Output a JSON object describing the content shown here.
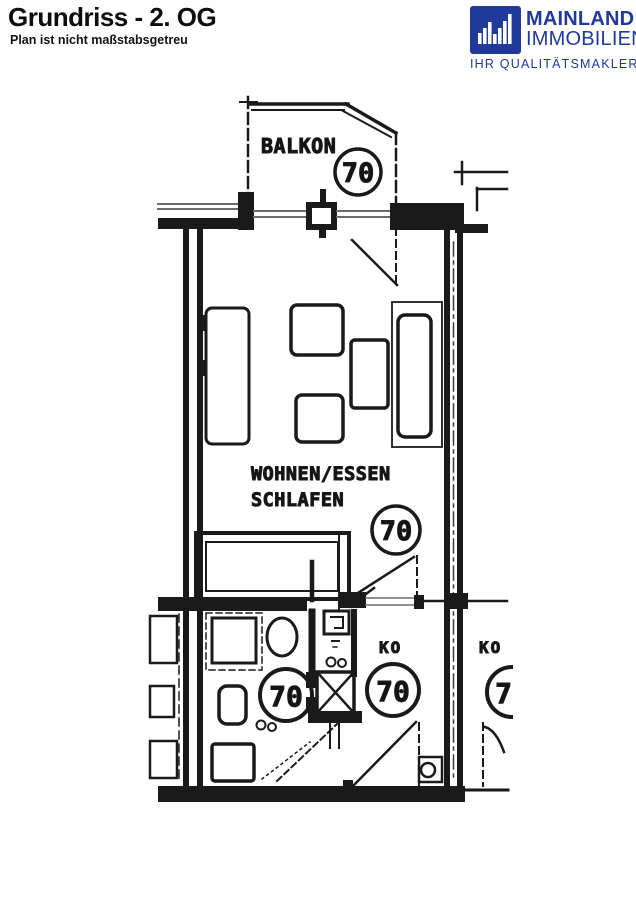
{
  "header": {
    "title": "Grundriss - 2. OG",
    "subtitle": "Plan ist nicht maßstabsgetreu",
    "logo": {
      "name_line1": "MAINLAND",
      "name_line2": "IMMOBILIEN",
      "tagline": "IHR QUALITÄTSMAKLER",
      "brand_color": "#21399B",
      "icon": "bar-chart-m-mark"
    }
  },
  "floorplan": {
    "ink_color": "#1a1a1a",
    "rooms": {
      "balcony_label": "BALKON",
      "living_label_line1": "WOHNEN/ESSEN",
      "living_label_line2": "SCHLAFEN",
      "corridor_label": "KO",
      "right_unit_corridor_label": "KO"
    },
    "unit_circles": [
      {
        "location": "balcony",
        "value": "70"
      },
      {
        "location": "living-room",
        "value": "70"
      },
      {
        "location": "bathroom",
        "value": "70"
      },
      {
        "location": "corridor",
        "value": "70"
      },
      {
        "location": "right-unit",
        "value": "70"
      }
    ]
  }
}
